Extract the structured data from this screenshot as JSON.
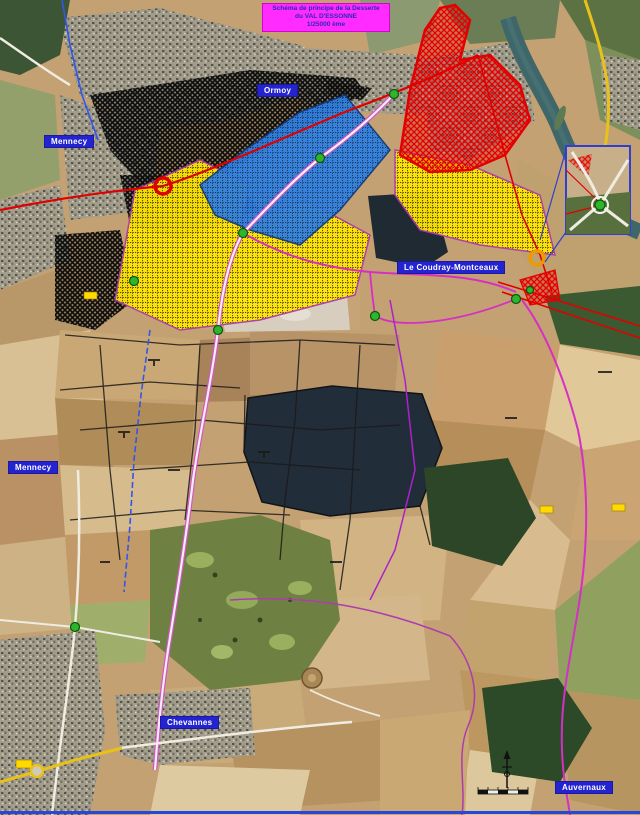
{
  "title_box": {
    "line1": "Schéma de principe de la Desserte",
    "line2": "du VAL D'ESSONNE",
    "line3": "1/25000 ème"
  },
  "place_labels": {
    "mennecy_north": "Mennecy",
    "ormoy": "Ormoy",
    "le_coudray": "Le Coudray-Montceaux",
    "mennecy_south": "Mennecy",
    "chevannes": "Chevannes",
    "auvernaux": "Auvernaux"
  },
  "colors": {
    "label_bg": "#2323cf",
    "label_text": "#ffffff",
    "title_bg": "#ff2bff",
    "title_text": "#2a2ab8",
    "zone_red": "#e30000",
    "zone_yellow": "#ffe500",
    "zone_blue": "#2f80e0",
    "zone_black_hatch": "#0d0d0d",
    "road_magenta": "#d355c9",
    "road_red": "#e00000",
    "road_yellow": "#e8c21a",
    "node_green": "#2db52d",
    "river": "#3f6769",
    "frame_blue": "#2947d6"
  }
}
